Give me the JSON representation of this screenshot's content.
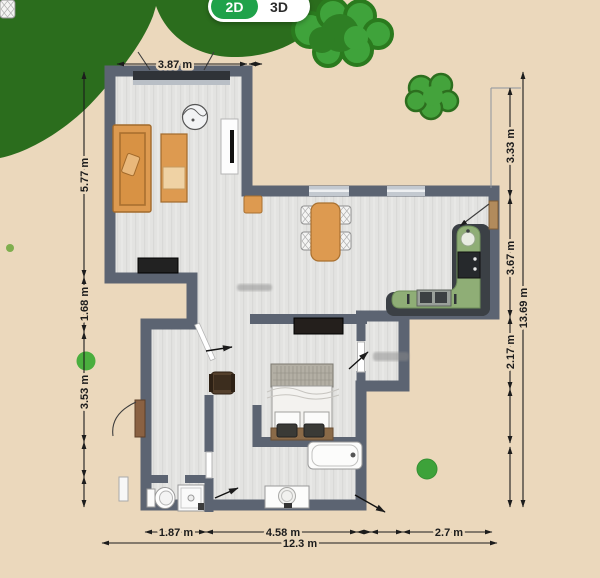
{
  "view_toggle": {
    "options": [
      {
        "label": "2D",
        "active": true
      },
      {
        "label": "3D",
        "active": false
      }
    ]
  },
  "dimensions": {
    "top": [
      "3.87 m"
    ],
    "left": [
      "5.77 m",
      "1.68 m",
      "3.53 m"
    ],
    "right_inner": [
      "3.33 m",
      "3.67 m",
      "2.17 m"
    ],
    "right_outer": "13.69 m",
    "bottom_inner": [
      "1.87 m",
      "4.58 m",
      "2.7 m"
    ],
    "bottom_outer": "12.3 m"
  },
  "colors": {
    "background": "#ebd8bc",
    "wall": "#5c6472",
    "floor": "#e3e3e1",
    "toggle_active_green": "#1fa24a",
    "furniture_orange": "#dd9a50",
    "counter_green": "#8fae76",
    "tree_dark_green": "#2b6d1d",
    "bush_green": "#3fa33b"
  }
}
